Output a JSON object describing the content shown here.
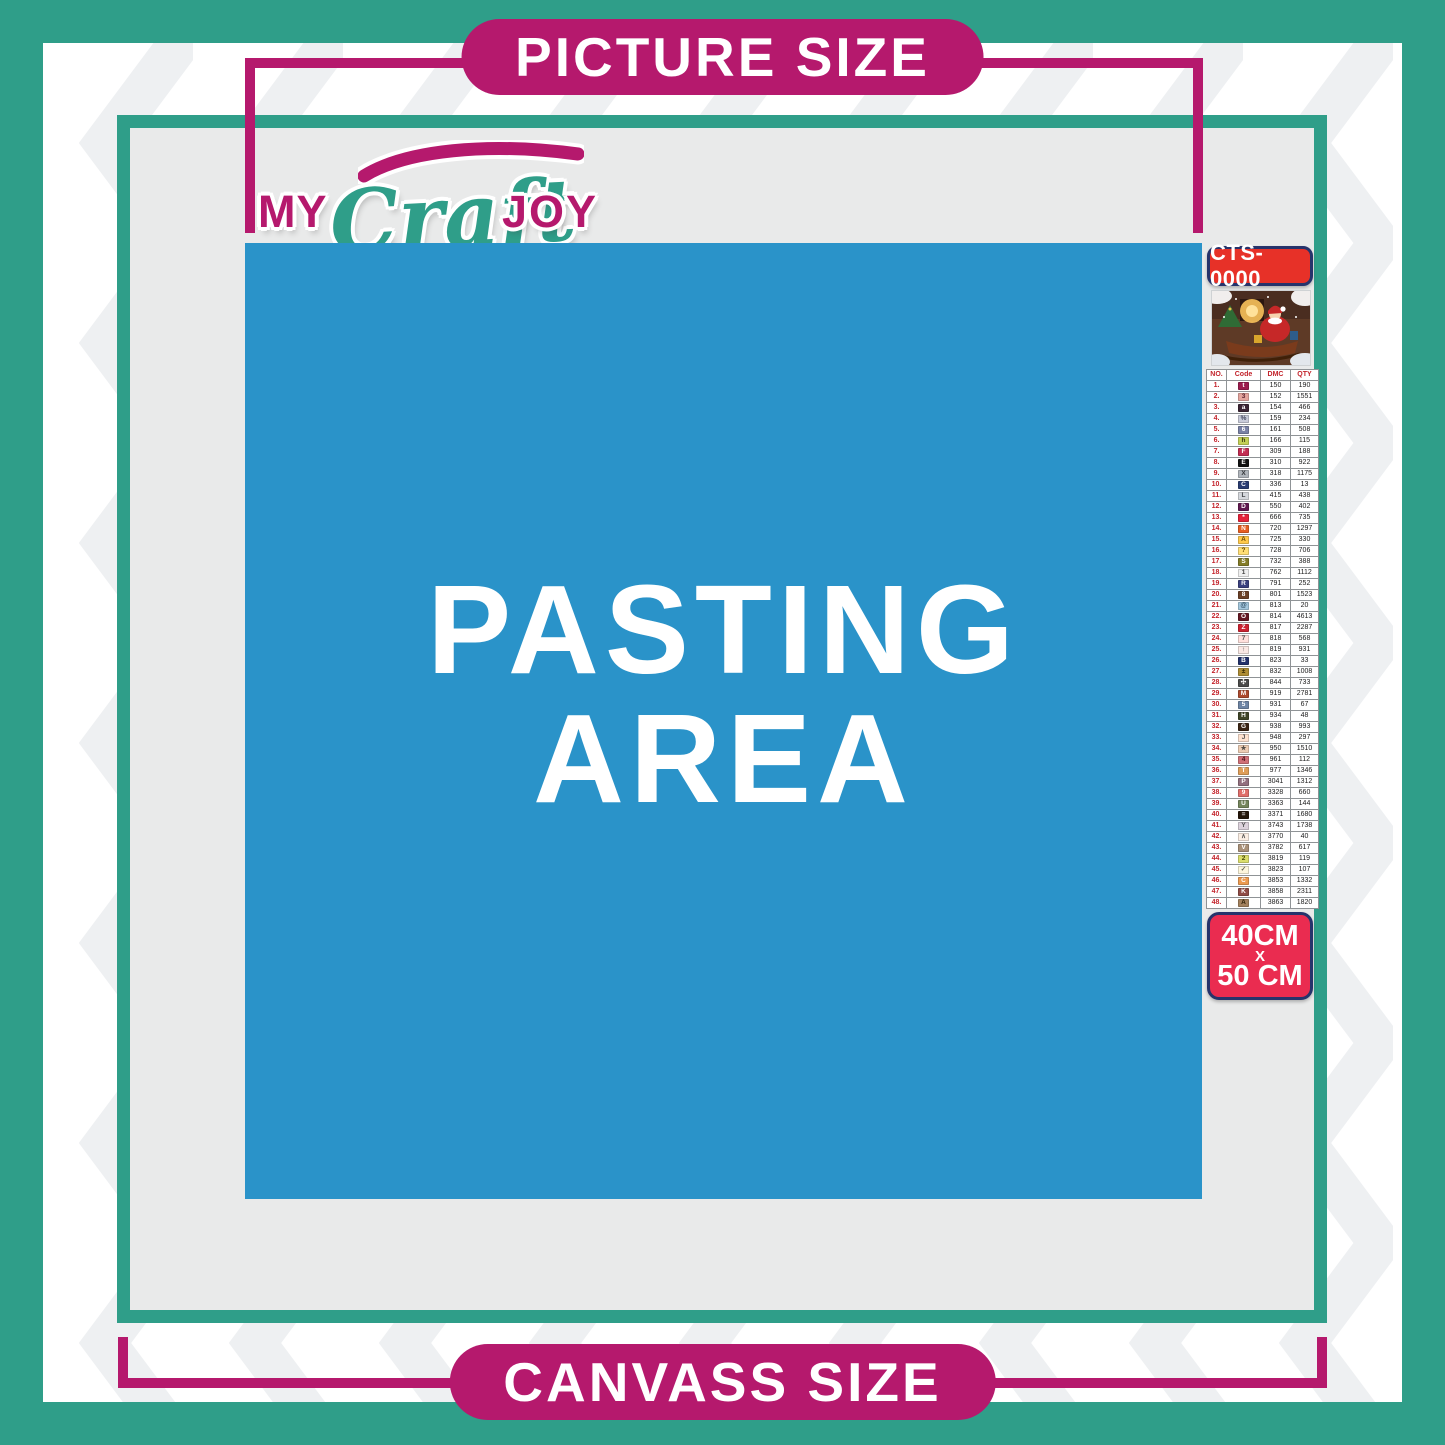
{
  "banners": {
    "picture_size": "PICTURE SIZE",
    "canvass_size": "CANVASS SIZE"
  },
  "logo": {
    "my": "MY",
    "craft": "Craft",
    "joy": "JOY"
  },
  "pasting_area": {
    "line1": "PASTING",
    "line2": "AREA"
  },
  "kit": {
    "code": "CTS-0000",
    "size_width": "40CM",
    "size_times": "X",
    "size_height": "50 CM"
  },
  "legend": {
    "headers": [
      "NO.",
      "Code",
      "DMC",
      "QTY"
    ],
    "rows": [
      {
        "no": "1.",
        "sym": "t",
        "dmc": "150",
        "qty": "190",
        "bg": "#9B1B4D",
        "fg": "#FFFFFF"
      },
      {
        "no": "2.",
        "sym": "3",
        "dmc": "152",
        "qty": "1551",
        "bg": "#E3A49D",
        "fg": "#5A2430"
      },
      {
        "no": "3.",
        "sym": "a",
        "dmc": "154",
        "qty": "466",
        "bg": "#3B2434",
        "fg": "#FFFFFF"
      },
      {
        "no": "4.",
        "sym": "%",
        "dmc": "159",
        "qty": "234",
        "bg": "#C9CCDA",
        "fg": "#44485E"
      },
      {
        "no": "5.",
        "sym": "6",
        "dmc": "161",
        "qty": "508",
        "bg": "#7A82A6",
        "fg": "#FFFFFF"
      },
      {
        "no": "6.",
        "sym": "h",
        "dmc": "166",
        "qty": "115",
        "bg": "#C3CF55",
        "fg": "#3A3A10"
      },
      {
        "no": "7.",
        "sym": "F",
        "dmc": "309",
        "qty": "188",
        "bg": "#C22D52",
        "fg": "#FFFFFF"
      },
      {
        "no": "8.",
        "sym": "E",
        "dmc": "310",
        "qty": "922",
        "bg": "#111111",
        "fg": "#FFFFFF"
      },
      {
        "no": "9.",
        "sym": "X",
        "dmc": "318",
        "qty": "1175",
        "bg": "#AFB4BA",
        "fg": "#33363A"
      },
      {
        "no": "10.",
        "sym": "C",
        "dmc": "336",
        "qty": "13",
        "bg": "#2A3C72",
        "fg": "#FFFFFF"
      },
      {
        "no": "11.",
        "sym": "L",
        "dmc": "415",
        "qty": "438",
        "bg": "#D5D8DD",
        "fg": "#44474B"
      },
      {
        "no": "12.",
        "sym": "D",
        "dmc": "550",
        "qty": "402",
        "bg": "#60194F",
        "fg": "#FFFFFF"
      },
      {
        "no": "13.",
        "sym": "*",
        "dmc": "666",
        "qty": "735",
        "bg": "#E42138",
        "fg": "#FFFFFF"
      },
      {
        "no": "14.",
        "sym": "N",
        "dmc": "720",
        "qty": "1297",
        "bg": "#E65E22",
        "fg": "#FFFFFF"
      },
      {
        "no": "15.",
        "sym": "A",
        "dmc": "725",
        "qty": "330",
        "bg": "#FFC94B",
        "fg": "#6B4A00"
      },
      {
        "no": "16.",
        "sym": "?",
        "dmc": "728",
        "qty": "706",
        "bg": "#FFDE75",
        "fg": "#6B4A00"
      },
      {
        "no": "17.",
        "sym": "S",
        "dmc": "732",
        "qty": "388",
        "bg": "#827B28",
        "fg": "#FFFFFF"
      },
      {
        "no": "18.",
        "sym": "1",
        "dmc": "762",
        "qty": "1112",
        "bg": "#EFEFEF",
        "fg": "#444444"
      },
      {
        "no": "19.",
        "sym": "R",
        "dmc": "791",
        "qty": "252",
        "bg": "#39407E",
        "fg": "#FFFFFF"
      },
      {
        "no": "20.",
        "sym": "8",
        "dmc": "801",
        "qty": "1523",
        "bg": "#6A4026",
        "fg": "#FFFFFF"
      },
      {
        "no": "21.",
        "sym": "@",
        "dmc": "813",
        "qty": "20",
        "bg": "#A3C6DC",
        "fg": "#2D4A60"
      },
      {
        "no": "22.",
        "sym": "O",
        "dmc": "814",
        "qty": "4613",
        "bg": "#641722",
        "fg": "#FFFFFF"
      },
      {
        "no": "23.",
        "sym": "Z",
        "dmc": "817",
        "qty": "2287",
        "bg": "#CB2231",
        "fg": "#FFFFFF"
      },
      {
        "no": "24.",
        "sym": "7",
        "dmc": "818",
        "qty": "568",
        "bg": "#FFE0DC",
        "fg": "#555555"
      },
      {
        "no": "25.",
        "sym": "↑",
        "dmc": "819",
        "qty": "931",
        "bg": "#FAE8E4",
        "fg": "#555555"
      },
      {
        "no": "26.",
        "sym": "B",
        "dmc": "823",
        "qty": "33",
        "bg": "#22306A",
        "fg": "#FFFFFF"
      },
      {
        "no": "27.",
        "sym": "±",
        "dmc": "832",
        "qty": "1008",
        "bg": "#AD8C35",
        "fg": "#2E2504"
      },
      {
        "no": "28.",
        "sym": "✣",
        "dmc": "844",
        "qty": "733",
        "bg": "#4A4A4A",
        "fg": "#FFFFFF"
      },
      {
        "no": "29.",
        "sym": "M",
        "dmc": "919",
        "qty": "2781",
        "bg": "#AC4A2F",
        "fg": "#FFFFFF"
      },
      {
        "no": "30.",
        "sym": "5",
        "dmc": "931",
        "qty": "67",
        "bg": "#6D84A4",
        "fg": "#FFFFFF"
      },
      {
        "no": "31.",
        "sym": "H",
        "dmc": "934",
        "qty": "48",
        "bg": "#3E4427",
        "fg": "#FFFFFF"
      },
      {
        "no": "32.",
        "sym": "G",
        "dmc": "938",
        "qty": "993",
        "bg": "#3A2414",
        "fg": "#FFFFFF"
      },
      {
        "no": "33.",
        "sym": "J",
        "dmc": "948",
        "qty": "297",
        "bg": "#FDE2D0",
        "fg": "#555555"
      },
      {
        "no": "34.",
        "sym": "★",
        "dmc": "950",
        "qty": "1510",
        "bg": "#EDCDB4",
        "fg": "#55504A"
      },
      {
        "no": "35.",
        "sym": "4",
        "dmc": "961",
        "qty": "112",
        "bg": "#CF7077",
        "fg": "#4D1118"
      },
      {
        "no": "36.",
        "sym": "T",
        "dmc": "977",
        "qty": "1346",
        "bg": "#DE9D58",
        "fg": "#FFFFFF"
      },
      {
        "no": "37.",
        "sym": "P",
        "dmc": "3041",
        "qty": "1312",
        "bg": "#92707F",
        "fg": "#FFFFFF"
      },
      {
        "no": "38.",
        "sym": "9",
        "dmc": "3328",
        "qty": "660",
        "bg": "#DF6E6A",
        "fg": "#FFFFFF"
      },
      {
        "no": "39.",
        "sym": "U",
        "dmc": "3363",
        "qty": "144",
        "bg": "#75855C",
        "fg": "#FFFFFF"
      },
      {
        "no": "40.",
        "sym": "=",
        "dmc": "3371",
        "qty": "1680",
        "bg": "#241609",
        "fg": "#FFFFFF"
      },
      {
        "no": "41.",
        "sym": "Y",
        "dmc": "3743",
        "qty": "1738",
        "bg": "#DCD2DC",
        "fg": "#555555"
      },
      {
        "no": "42.",
        "sym": "∧",
        "dmc": "3770",
        "qty": "40",
        "bg": "#FBEEE3",
        "fg": "#555555"
      },
      {
        "no": "43.",
        "sym": "V",
        "dmc": "3782",
        "qty": "617",
        "bg": "#A99179",
        "fg": "#FFFFFF"
      },
      {
        "no": "44.",
        "sym": "2",
        "dmc": "3819",
        "qty": "119",
        "bg": "#DBDE6C",
        "fg": "#474A07"
      },
      {
        "no": "45.",
        "sym": "✓",
        "dmc": "3823",
        "qty": "107",
        "bg": "#FDF6DC",
        "fg": "#666655"
      },
      {
        "no": "46.",
        "sym": "C",
        "dmc": "3853",
        "qty": "1332",
        "bg": "#EC9A50",
        "fg": "#FFFFFF"
      },
      {
        "no": "47.",
        "sym": "K",
        "dmc": "3858",
        "qty": "2311",
        "bg": "#8F4B45",
        "fg": "#FFFFFF"
      },
      {
        "no": "48.",
        "sym": "A",
        "dmc": "3863",
        "qty": "1820",
        "bg": "#A2805C",
        "fg": "#2E2008"
      }
    ]
  },
  "colors": {
    "teal": "#2F9E89",
    "magenta": "#B5196D",
    "blue": "#2A93C9",
    "canvas": "#E9EAEA",
    "badge_red": "#E73128",
    "badge_crimson": "#EA2C50",
    "badge_border": "#26336B",
    "header_red": "#C3232B",
    "chevron": "#EEF0F2"
  }
}
